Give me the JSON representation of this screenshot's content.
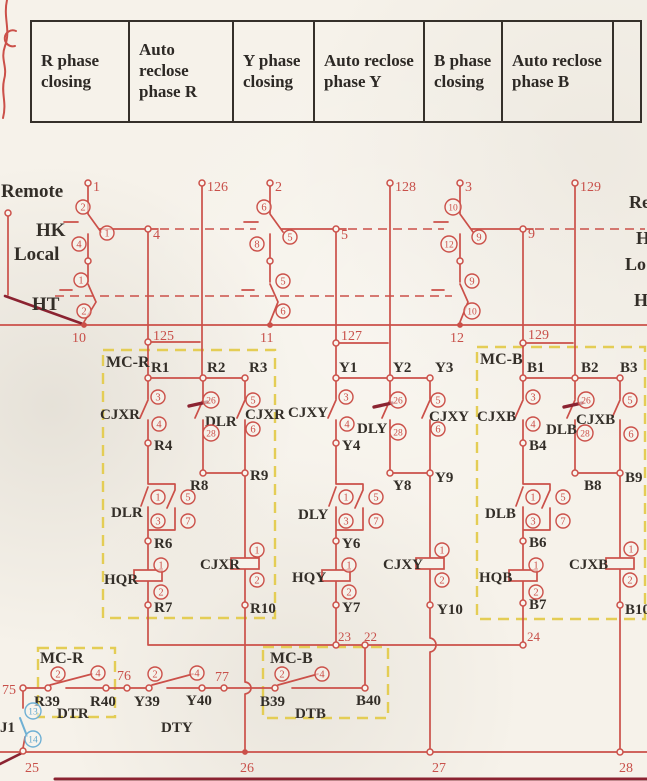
{
  "table": {
    "headers": [
      "R phase closing",
      "Auto reclose phase R",
      "Y phase closing",
      "Auto reclose phase Y",
      "B phase closing",
      "Auto reclose phase B"
    ]
  },
  "switch_labels": {
    "remote": "Remote",
    "hk": "HK",
    "local": "Local",
    "ht": "HT"
  },
  "right_edge": {
    "remote": "Re",
    "hk": "H",
    "local": "Lo",
    "ht": "H"
  },
  "terminals": {
    "t1": "1",
    "t2": "2",
    "t3": "3",
    "t125": "125",
    "t126": "126",
    "t127": "127",
    "t128": "128",
    "t129": "129",
    "t129b": "129",
    "n4": "4",
    "n5": "5",
    "n9": "9",
    "n10": "10",
    "n11": "11",
    "n12": "12",
    "n22": "22",
    "n23": "23",
    "n24": "24",
    "n25": "25",
    "n26": "26",
    "n27": "27",
    "n28": "28",
    "t75": "75",
    "t76": "76",
    "t77": "77"
  },
  "pins": {
    "p1": "1",
    "p2": "2",
    "p3": "3",
    "p4": "4",
    "p5": "5",
    "p6": "6",
    "p7": "7",
    "p8": "8",
    "p9": "9",
    "p10": "10",
    "p12": "12",
    "p13": "13",
    "p14": "14",
    "p26": "26",
    "p28": "28"
  },
  "mcr": {
    "name": "MC-R",
    "r1": "R1",
    "r2": "R2",
    "r3": "R3",
    "cjx1": "CJXR",
    "dl1": "DLR",
    "cjx2": "CJXR",
    "r4": "R4",
    "r8": "R8",
    "r9": "R9",
    "dl2": "DLR",
    "r6": "R6",
    "hq": "HQR",
    "cjx3": "CJXR",
    "r7": "R7",
    "r10": "R10"
  },
  "mcy": {
    "y1": "Y1",
    "y2": "Y2",
    "y3": "Y3",
    "cjx1": "CJXY",
    "dl1": "DLY",
    "cjx2": "CJXY",
    "y4": "Y4",
    "y8": "Y8",
    "y9": "Y9",
    "dl2": "DLY",
    "y6": "Y6",
    "hq": "HQY",
    "cjx3": "CJXY",
    "y7": "Y7",
    "y10": "Y10"
  },
  "mcb": {
    "name": "MC-B",
    "b1": "B1",
    "b2": "B2",
    "b3": "B3",
    "cjx1": "CJXB",
    "dl1": "DLB",
    "cjx2": "CJXB",
    "b4": "B4",
    "b8": "B8",
    "b9": "B9",
    "dl2": "DLB",
    "b6": "B6",
    "hq": "HQB",
    "cjx3": "CJXB",
    "b7": "B7",
    "b10": "B10"
  },
  "bottom": {
    "mcr_name": "MC-R",
    "mcb_name": "MC-B",
    "r39": "R39",
    "r40": "R40",
    "y39": "Y39",
    "y40": "Y40",
    "b39": "B39",
    "b40": "B40",
    "dtr": "DTR",
    "dty": "DTY",
    "dtb": "DTB",
    "kj1": "J1"
  }
}
